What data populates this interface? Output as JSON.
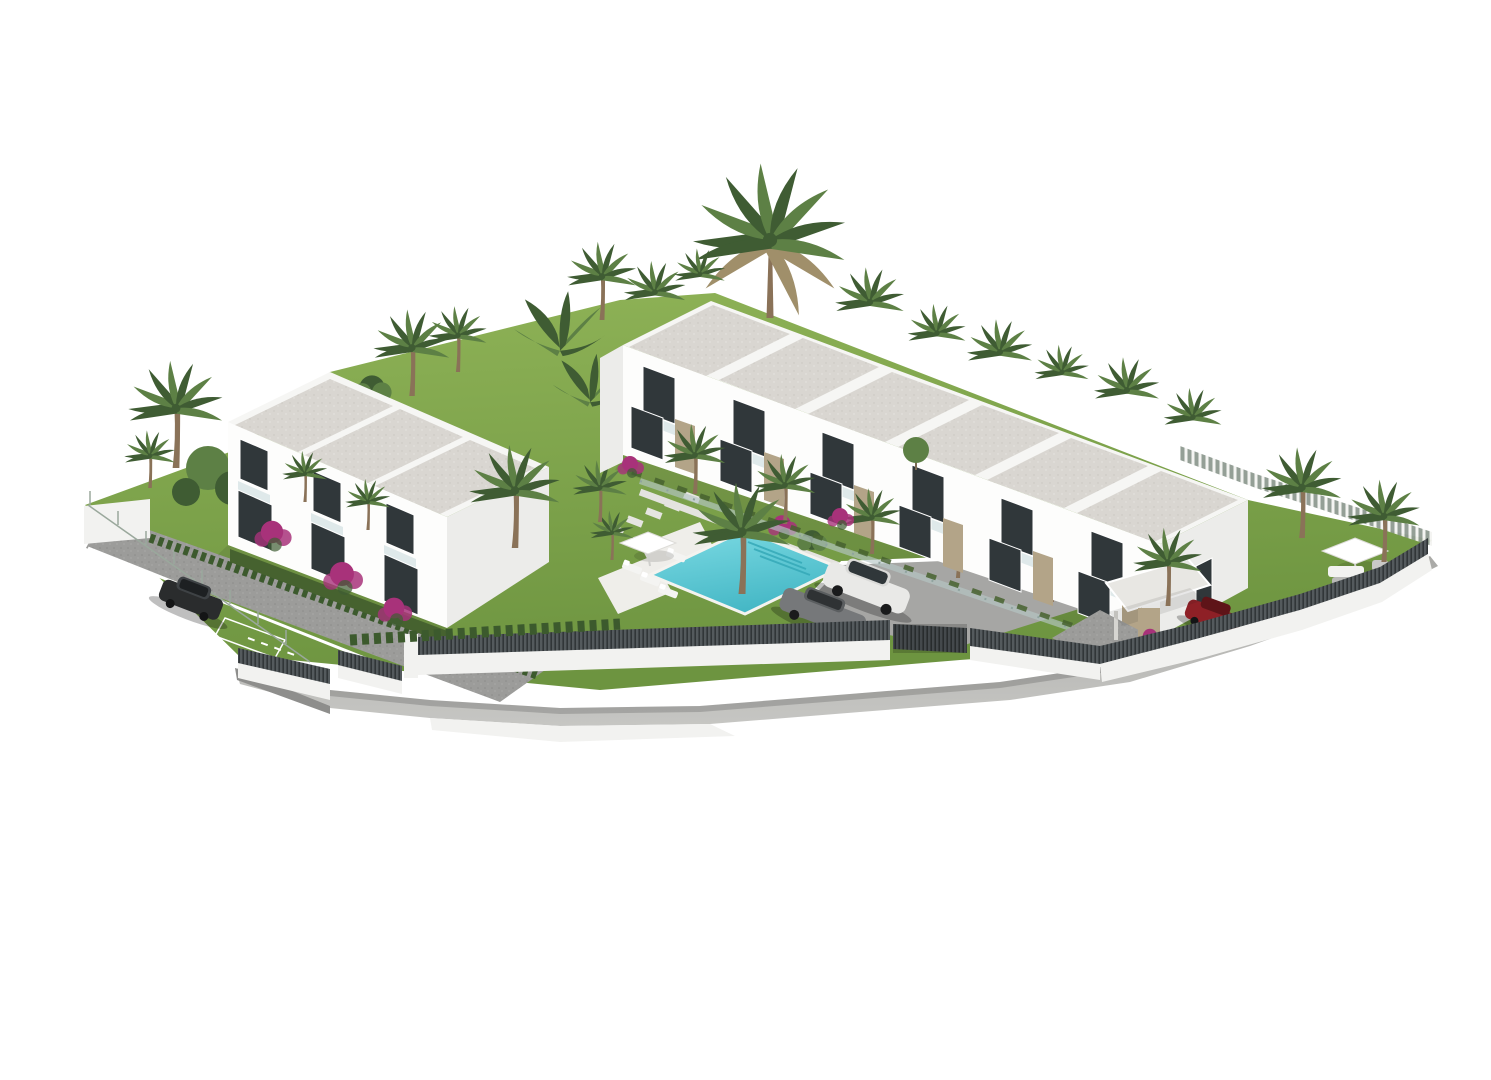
{
  "scene": {
    "description": "3D architectural rendering of a white modern townhouse development on a terraced plot: a two-storey block on the left, a long terraced row of six townhouses on the right, communal turquoise swimming pool with sun loungers and parasol, parking court with cars, landscaped gardens with palm trees, banana plants and magenta bougainvillea, all enclosed by white walls topped with dark slatted fencing, on a plain white background.",
    "buildings": {
      "left_block": {
        "label": "two-storey townhouse block",
        "units_visible": 3,
        "roof_panels": 3
      },
      "right_block": {
        "label": "terraced townhouse row",
        "units_visible": 6,
        "roof_panels": 6
      }
    },
    "amenities": {
      "pool": "communal swimming pool with steps and loungers",
      "parking": "interior parking court",
      "right_garden": "private lawn with parasol and lounge set",
      "driveway": "cobbled side driveway with parking bay"
    },
    "vehicles": [
      {
        "label": "white SUV"
      },
      {
        "label": "grey sedan"
      },
      {
        "label": "dark hatchback"
      },
      {
        "label": "red sedan"
      }
    ],
    "vegetation": [
      "tall date palm",
      "palm trees",
      "banana plants",
      "bougainvillea",
      "cypress hedges",
      "lawns"
    ]
  },
  "colors": {
    "background": "#ffffff",
    "building_front": "#fdfdfc",
    "building_side": "#ececea",
    "parapet": "#f6f6f4",
    "roof_gravel": "#d9d6d1",
    "roof_gravel_dot1": "#c9c6c0",
    "roof_gravel_dot2": "#e8e6e1",
    "window": "#30373a",
    "glass": "#c7d8da",
    "stone": "#b3a488",
    "lawn_light": "#8fb357",
    "lawn_dark": "#6d9440",
    "hedge": "#46622f",
    "palm_green": "#5d8045",
    "palm_dark": "#3f5c33",
    "palm_dry": "#a08f6a",
    "trunk": "#8a7258",
    "bougainvillea": "#a8327a",
    "pool_light": "#7ddbe4",
    "pool_deep": "#46b8c6",
    "deck": "#efeeea",
    "paving": "#9c9c9a",
    "road_light": "#c6c6c3",
    "road_dark": "#a9a9a6",
    "asphalt": "#a6a6a4",
    "wall_white": "#f2f2f0",
    "slat_fence": "#545a5d",
    "slat_dark": "#313638",
    "picket_bg": "#8e9a90",
    "picket_slat": "#f3f3f1",
    "car_white": "#e9e9e7",
    "car_gray": "#76787a",
    "car_black": "#2a2c2d",
    "car_red": "#8e2026"
  }
}
